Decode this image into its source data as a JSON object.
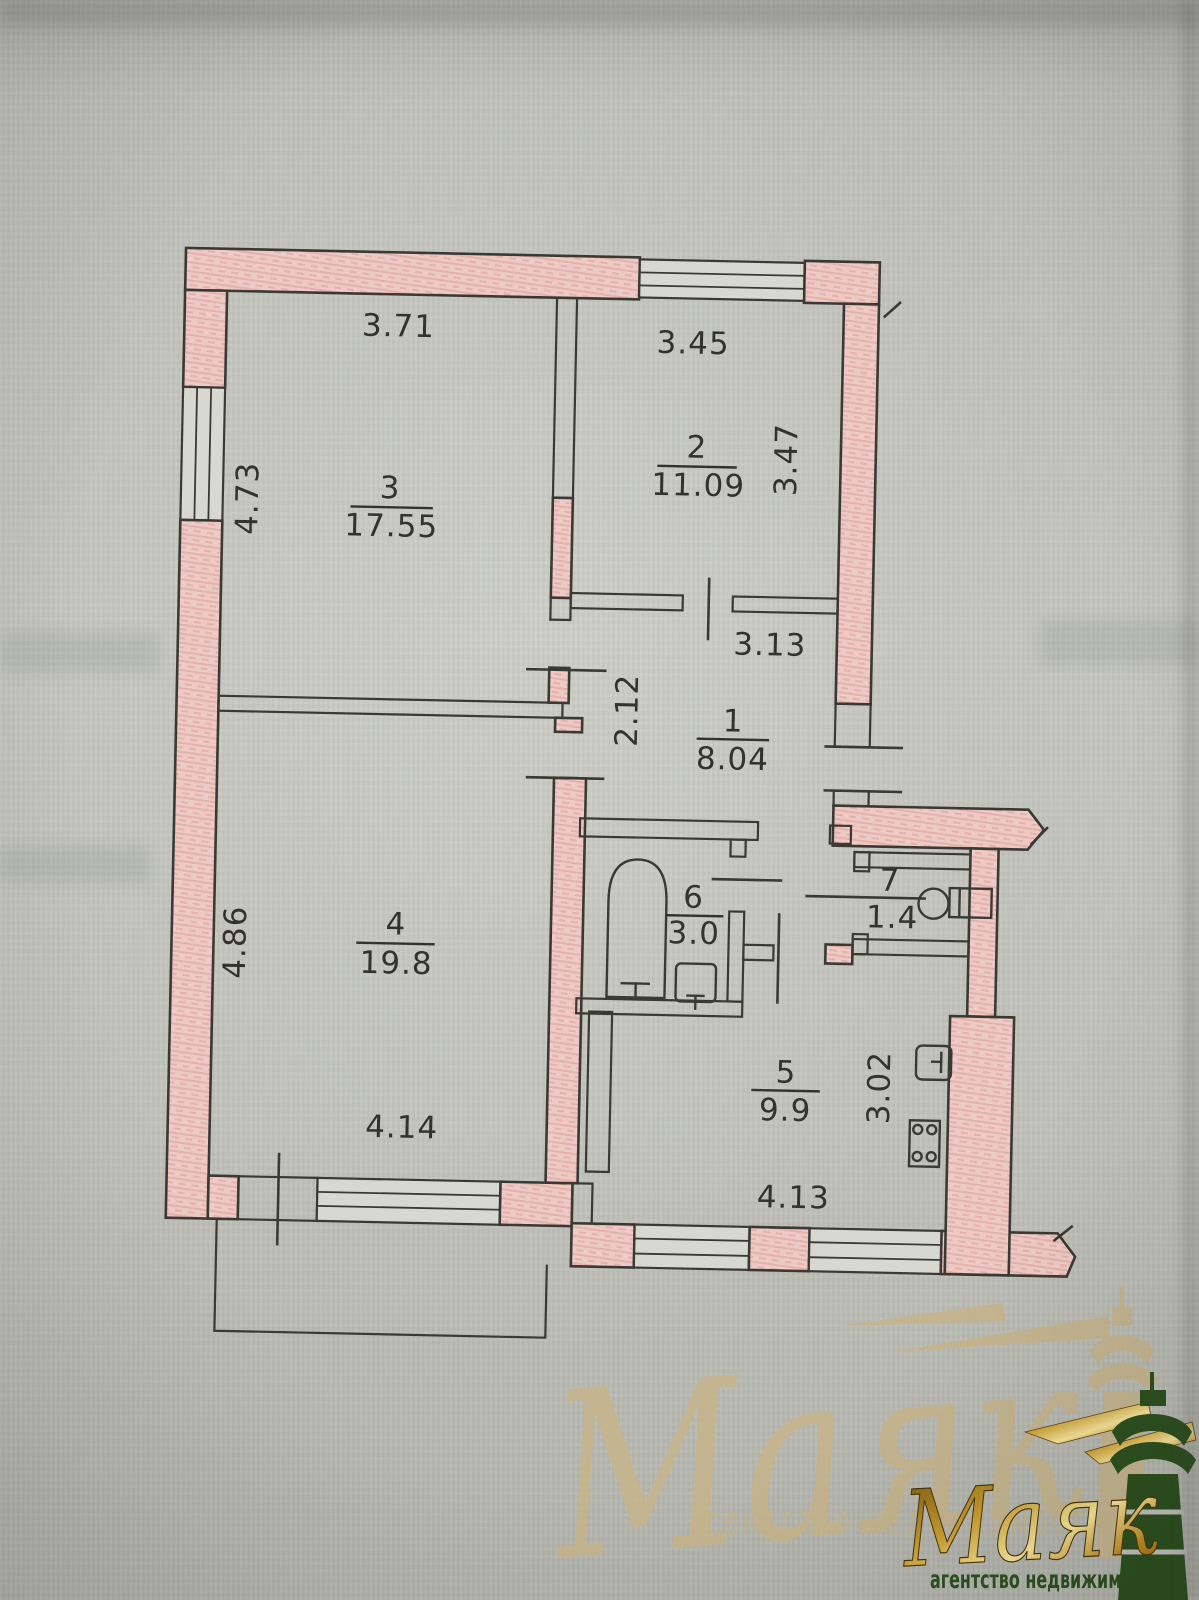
{
  "plan": {
    "rooms": {
      "r1": {
        "number": "1",
        "area": "8.04"
      },
      "r2": {
        "number": "2",
        "area": "11.09"
      },
      "r3": {
        "number": "3",
        "area": "17.55"
      },
      "r4": {
        "number": "4",
        "area": "19.8"
      },
      "r5": {
        "number": "5",
        "area": "9.9"
      },
      "r6": {
        "number": "6",
        "area": "3.0"
      },
      "r7": {
        "number": "7",
        "area": "1.4"
      }
    },
    "dimensions": {
      "room3_width": "3.71",
      "room2_width": "3.45",
      "room3_height": "4.73",
      "room2_height": "3.47",
      "hall_width": "3.13",
      "hall_segment": "2.12",
      "room4_height": "4.86",
      "room4_width": "4.14",
      "kitchen_height": "3.02",
      "kitchen_width": "4.13"
    },
    "colors": {
      "wall_fill": "#edcac5",
      "wall_hatch": "#dfa49d",
      "line": "#3a3934",
      "paper": "#c2c4bc"
    }
  },
  "watermark_ghost": {
    "brand": "Маяк",
    "tagline": "агентство недвижимости",
    "color": "#c6b48c"
  },
  "watermark_logo": {
    "brand": "Маяк",
    "tagline": "агентство недвижимости",
    "gold": "#c89c2e",
    "green": "#2d5020"
  }
}
